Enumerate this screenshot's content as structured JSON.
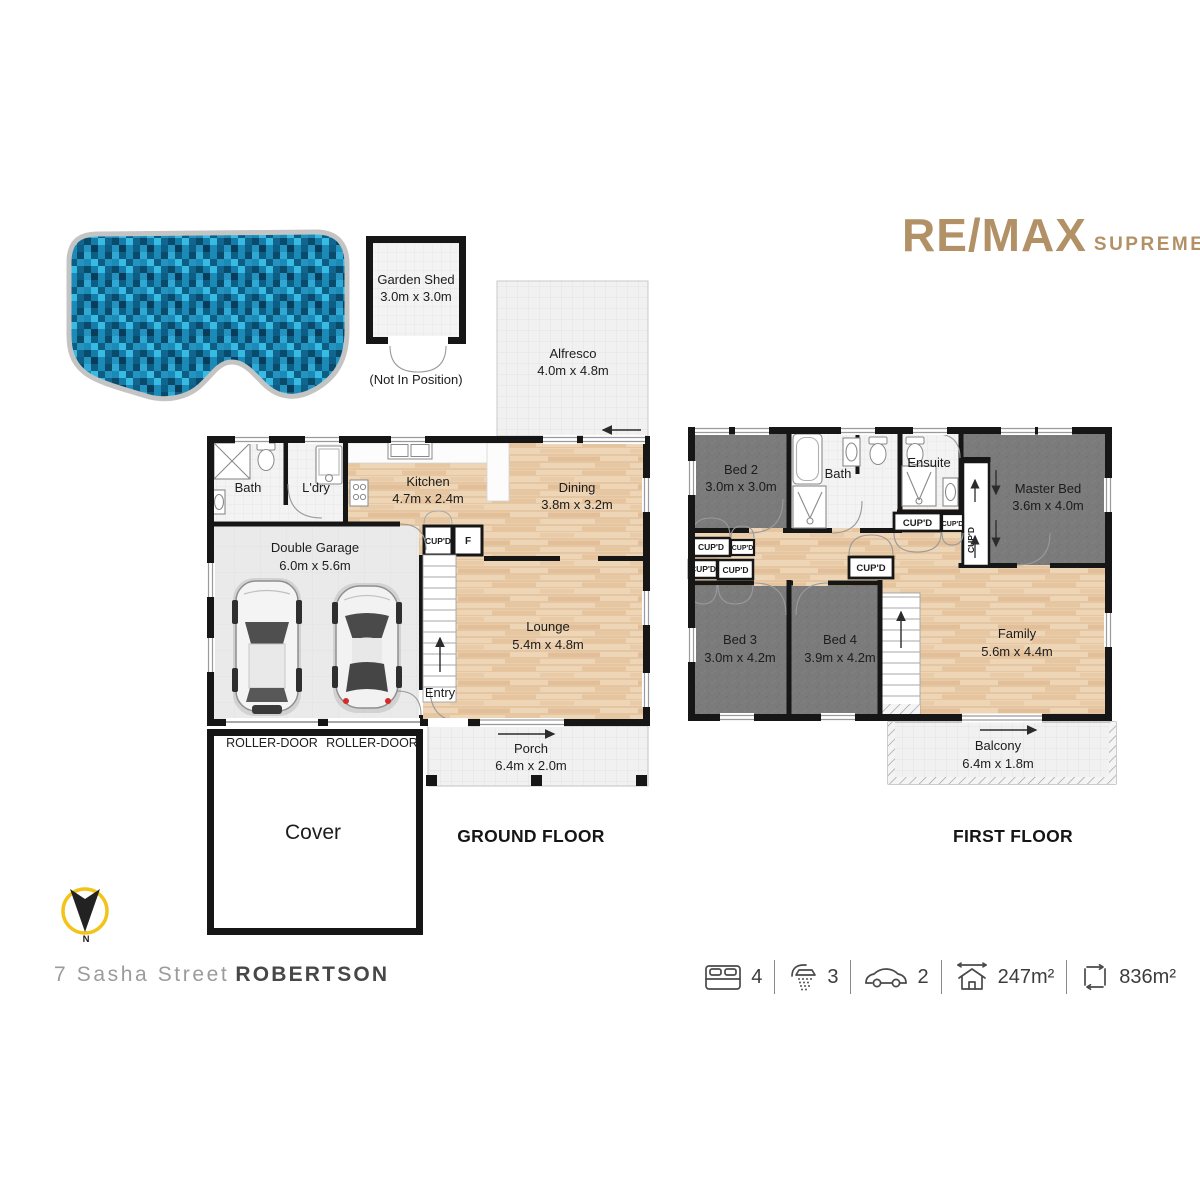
{
  "branding": {
    "logo_main": "RE/MAX",
    "logo_sub": "SUPREME",
    "accent_color": "#b29167"
  },
  "site": {
    "shed_name": "Garden Shed",
    "shed_dims": "3.0m x 3.0m",
    "shed_note": "(Not In Position)"
  },
  "labels": {
    "cupd": "CUP'D",
    "fridge": "F",
    "roller_door": "ROLLER-DOOR",
    "cover": "Cover",
    "entry": "Entry",
    "north": "N"
  },
  "ground_floor": {
    "title": "GROUND FLOOR",
    "alfresco_name": "Alfresco",
    "alfresco_dims": "4.0m x 4.8m",
    "bath_name": "Bath",
    "ldry_name": "L'dry",
    "kitchen_name": "Kitchen",
    "kitchen_dims": "4.7m x 2.4m",
    "dining_name": "Dining",
    "dining_dims": "3.8m x 3.2m",
    "garage_name": "Double Garage",
    "garage_dims": "6.0m x 5.6m",
    "lounge_name": "Lounge",
    "lounge_dims": "5.4m x 4.8m",
    "porch_name": "Porch",
    "porch_dims": "6.4m x 2.0m"
  },
  "first_floor": {
    "title": "FIRST FLOOR",
    "bed2_name": "Bed 2",
    "bed2_dims": "3.0m x 3.0m",
    "bath_name": "Bath",
    "ensuite_name": "Ensuite",
    "master_name": "Master Bed",
    "master_dims": "3.6m x 4.0m",
    "bed3_name": "Bed 3",
    "bed3_dims": "3.0m x 4.2m",
    "bed4_name": "Bed 4",
    "bed4_dims": "3.9m x 4.2m",
    "family_name": "Family",
    "family_dims": "5.6m x 4.4m",
    "balcony_name": "Balcony",
    "balcony_dims": "6.4m x 1.8m"
  },
  "address": {
    "street": "7 Sasha Street",
    "suburb": "ROBERTSON"
  },
  "stats": {
    "beds": "4",
    "baths": "3",
    "cars": "2",
    "house_area": "247m²",
    "land_area": "836m²"
  },
  "palette": {
    "wall": "#161616",
    "wood": "#eed5b6",
    "carpet": "#7b7b7b",
    "tile": "#f1f1f1",
    "pool_blue": "#157ca9",
    "compass_yellow": "#f3c319"
  }
}
